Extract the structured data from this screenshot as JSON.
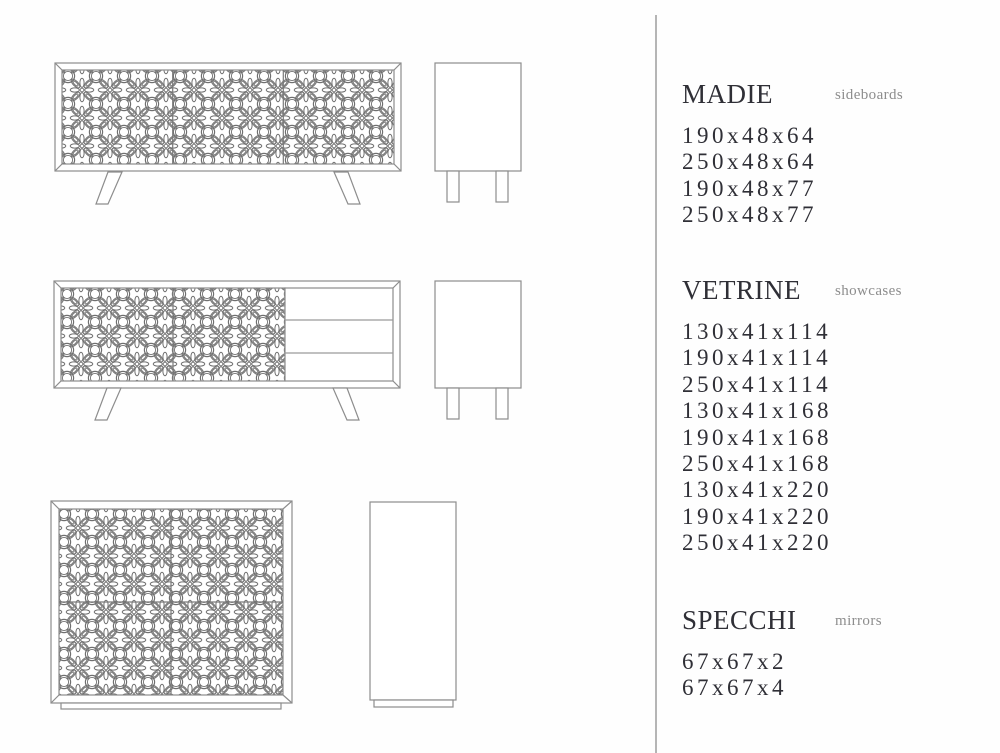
{
  "colors": {
    "background": "#ffffff",
    "text": "#2f2f36",
    "subtitle": "#8d8d8d",
    "divider": "#b5b5b5",
    "drawing_frame_line": "#8d8d8d",
    "pattern_line": "#6f6f6f"
  },
  "sections": {
    "madie": {
      "title": "MADIE",
      "subtitle": "sideboards",
      "items": [
        "190x48x64",
        "250x48x64",
        "190x48x77",
        "250x48x77"
      ]
    },
    "vetrine": {
      "title": "VETRINE",
      "subtitle": "showcases",
      "items": [
        "130x41x114",
        "190x41x114",
        "250x41x114",
        "130x41x168",
        "190x41x168",
        "250x41x168",
        "130x41x220",
        "190x41x220",
        "250x41x220"
      ]
    },
    "specchi": {
      "title": "SPECCHI",
      "subtitle": "mirrors",
      "items": [
        "67x67x2",
        "67x67x4"
      ]
    }
  },
  "drawings": {
    "sideboard_front": "three-door-carved-sideboard-front-view",
    "sideboard_side": "sideboard-side-view-with-legs",
    "sideboard_drawers_front": "two-door-three-drawer-sideboard-front-view",
    "sideboard_drawers_side": "sideboard-side-view-with-legs",
    "showcase_front": "four-door-carved-showcase-front-view",
    "showcase_side": "showcase-side-view"
  }
}
